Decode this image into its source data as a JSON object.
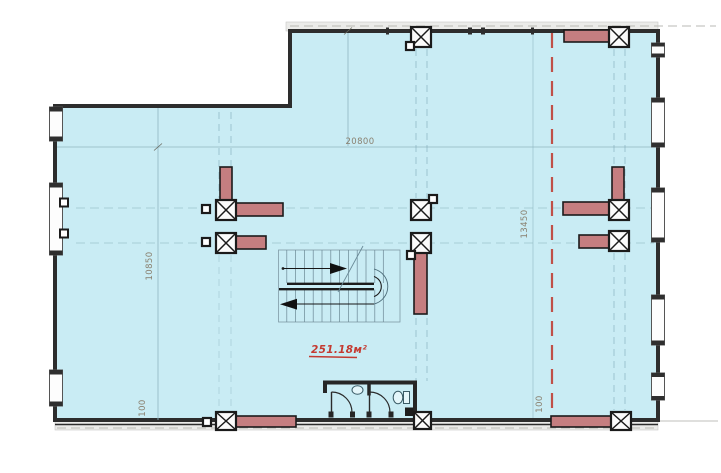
{
  "page": {
    "width": 721,
    "height": 473,
    "background": "#ffffff"
  },
  "floor_plan": {
    "area_label": "251.18м²",
    "dimensions": {
      "width_label": "20800",
      "height_left_label": "10850",
      "height_right_label": "13450",
      "offset_bottom_left_label": "100",
      "offset_bottom_right_label": "100"
    },
    "colors": {
      "floor_fill": "#c9ecf4",
      "wall": "#2d2d2d",
      "column_fill": "#c57e80",
      "column_stroke": "#1b1b1b",
      "grid_line": "#8fb6c0",
      "axis_dashed_red": "#c05048",
      "dim_text": "#8a8170",
      "area_text": "#c43a31",
      "exterior_band": "#ebebe9"
    },
    "features": {
      "columns": "cross-marked square columns with red-brown blade walls",
      "staircase": "double-flight U-turn stair with up/down arrows",
      "sanitary_room": "WC cubicles with sink and toilet",
      "axis": "red dashed vertical axis line"
    }
  }
}
